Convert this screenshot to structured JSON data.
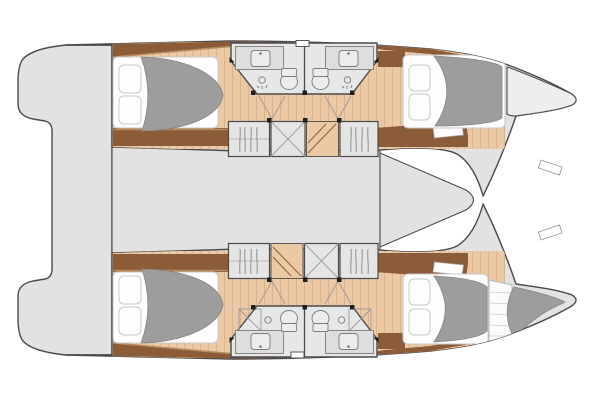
{
  "title": "Catamaran 4-cabin deck plan (top view)",
  "colors": {
    "background": "#ffffff",
    "deck": "#e2e2e2",
    "deck_light": "#eeeeee",
    "bath": "#e7e7e7",
    "outline": "#4a4a4a",
    "duvet": "#9d9d9d",
    "duvet_edge": "#858585",
    "mattress": "#fefefe",
    "mattress_edge": "#c8c8c8",
    "wood_dark": "#8c5c38",
    "wood_mid": "#b78a5c",
    "wood_tan": "#ebc9a5",
    "wood_plank": "#d9b48c",
    "furniture": "#e5e5e5",
    "fixture": "#ececec",
    "fixture_line": "#7d7d7d",
    "post": "#1f1f1f"
  },
  "vessel": {
    "type": "catamaran",
    "view": "interior layout plan",
    "hulls": [
      {
        "name": "port hull (top)",
        "rooms": [
          "aft double cabin",
          "bathroom",
          "bathroom",
          "forward double cabin",
          "bow locker"
        ],
        "furniture": [
          "wardrobe",
          "storage locker",
          "companionway stairs",
          "wardrobe"
        ],
        "fixtures": [
          "toilet",
          "washbasin",
          "shower",
          "toilet",
          "washbasin",
          "shower"
        ]
      },
      {
        "name": "starboard hull (bottom)",
        "rooms": [
          "aft double cabin",
          "bathroom",
          "bathroom",
          "forward double cabin",
          "forepeak berth"
        ],
        "furniture": [
          "wardrobe",
          "companionway stairs",
          "storage locker",
          "wardrobe"
        ],
        "fixtures": [
          "toilet",
          "washbasin",
          "shower",
          "toilet",
          "washbasin",
          "shower"
        ]
      }
    ],
    "bridgedeck": [
      "saloon",
      "foredeck"
    ],
    "stern": [
      "aft platform",
      "transom steps"
    ]
  }
}
